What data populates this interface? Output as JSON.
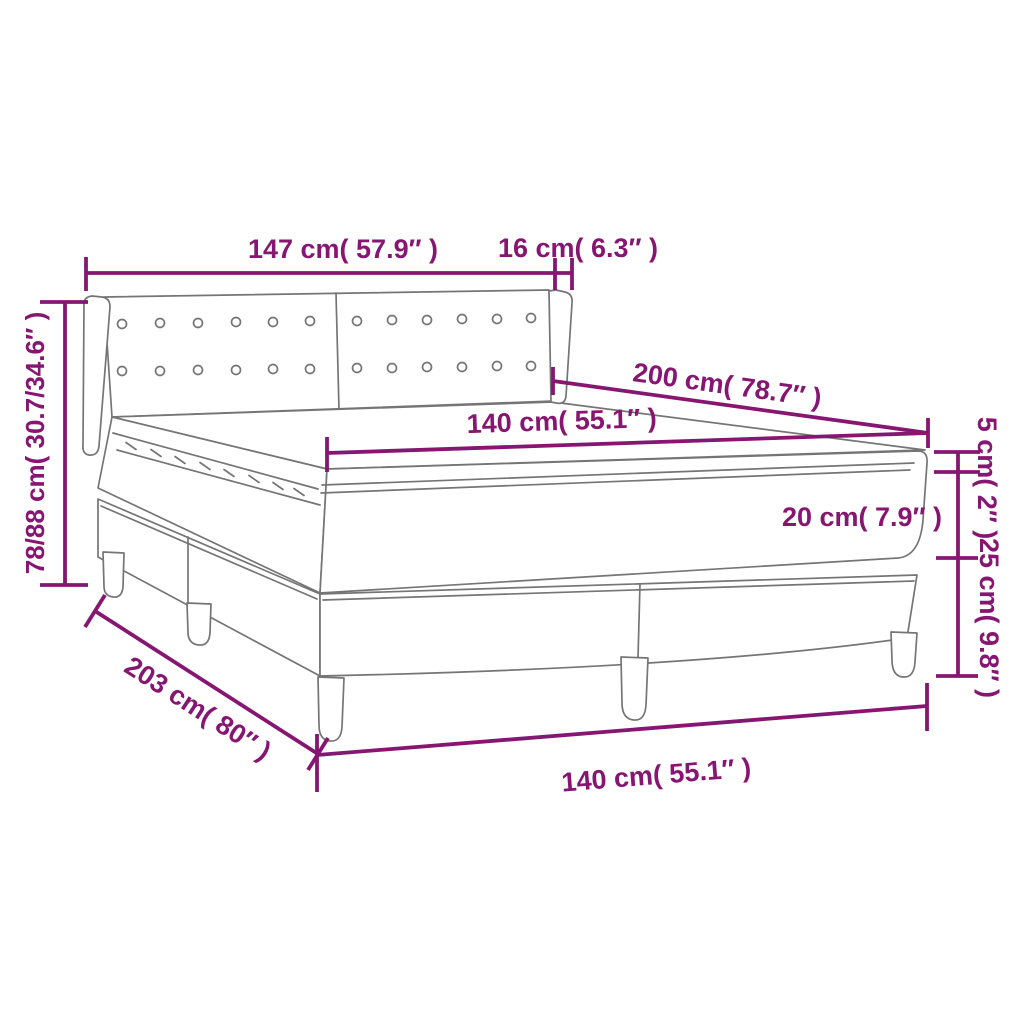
{
  "diagram": {
    "type": "product-dimension-diagram",
    "subject": "box spring bed with upholstered headboard, mattress and topper",
    "accent_color": "#861672",
    "line_color": "#757575",
    "background_color": "#ffffff",
    "dimensions": [
      {
        "id": "headboard-width",
        "label": "147 cm( 57.9″ )",
        "cm": "147",
        "inch": "57.9"
      },
      {
        "id": "headboard-wing-depth",
        "label": "16 cm( 6.3″ )",
        "cm": "16",
        "inch": "6.3"
      },
      {
        "id": "bed-length",
        "label": "200 cm( 78.7″ )",
        "cm": "200",
        "inch": "78.7"
      },
      {
        "id": "mattress-width",
        "label": "140 cm( 55.1″ )",
        "cm": "140",
        "inch": "55.1"
      },
      {
        "id": "topper-thickness",
        "label": "5 cm( 2″ )",
        "cm": "5",
        "inch": "2"
      },
      {
        "id": "mattress-thickness",
        "label": "20 cm( 7.9″ )",
        "cm": "20",
        "inch": "7.9"
      },
      {
        "id": "base-height",
        "label": "25 cm( 9.8″ )",
        "cm": "25",
        "inch": "9.8"
      },
      {
        "id": "overall-height",
        "label": "78/88 cm( 30.7/34.6″ )",
        "cm": "78/88",
        "inch": "30.7/34.6"
      },
      {
        "id": "overall-length",
        "label": "203 cm( 80″ )",
        "cm": "203",
        "inch": "80"
      },
      {
        "id": "base-width",
        "label": "140 cm( 55.1″ )",
        "cm": "140",
        "inch": "55.1"
      }
    ]
  }
}
